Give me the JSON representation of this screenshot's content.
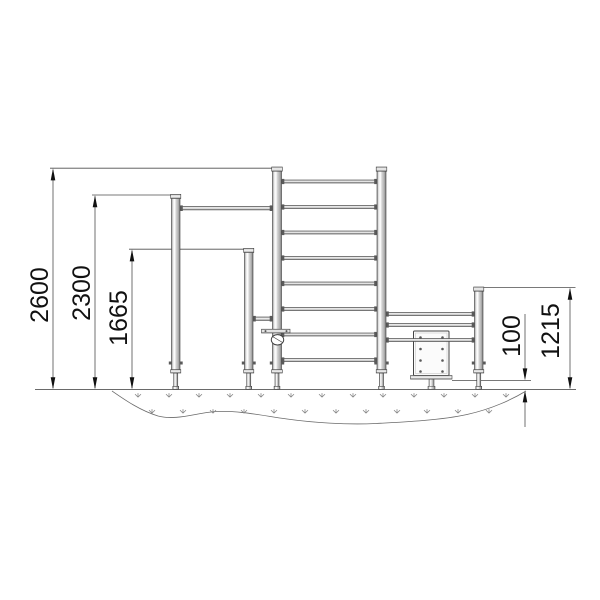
{
  "drawing": {
    "kind": "playground-workout-equipment-side-elevation",
    "background_color": "#ffffff",
    "line_color": "#4d4d4d",
    "text_color": "#111111",
    "units": "mm"
  },
  "dimensions": {
    "overall_height": "2600",
    "pullup_bar_height": "2300",
    "low_bar_height": "1665",
    "bench_ground_clearance": "100",
    "right_frame_height": "1215"
  },
  "symbols": {
    "grass_marks": "grass-tick-icon",
    "ground_section": "surfacing-pit-outline"
  }
}
